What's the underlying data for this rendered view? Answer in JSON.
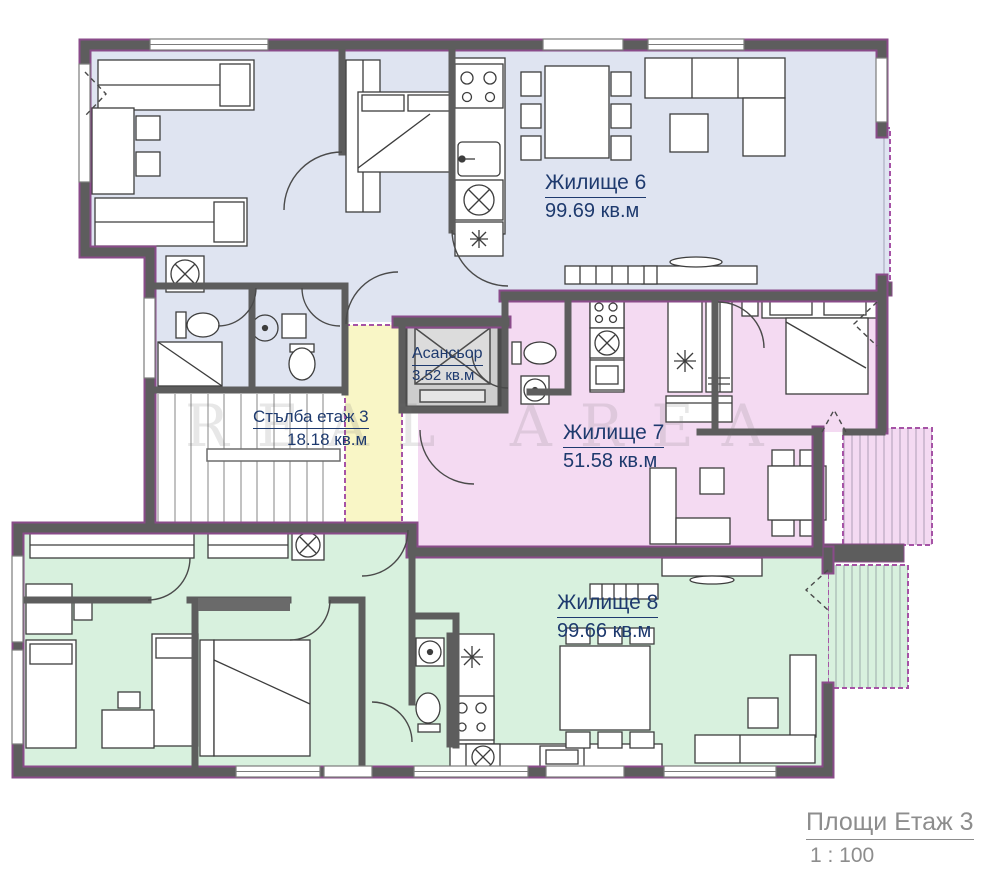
{
  "plan": {
    "watermark": "REAL AREA",
    "apartments": [
      {
        "name": "Жилище 6",
        "area": "99.69 кв.м",
        "color": "#dfe4f1"
      },
      {
        "name": "Жилище 7",
        "area": "51.58 кв.м",
        "color": "#f4daf2"
      },
      {
        "name": "Жилище 8",
        "area": "99.66 кв.м",
        "color": "#d8f1de"
      }
    ],
    "core": {
      "elevator_name": "Асансьор",
      "elevator_area": "3.52 кв.м",
      "stairs_name": "Стълба етаж 3",
      "stairs_area": "18.18 кв.м",
      "lobby_color": "#f9f6c6"
    },
    "title": {
      "label": "Площи Етаж 3",
      "scale": "1 : 100"
    },
    "colors": {
      "wall": "#5d5d5d",
      "outline": "#8a4b8a",
      "shaft": "#cdcdcd",
      "label_text": "#1e3a6e",
      "title_text": "#8d8d8d"
    }
  }
}
